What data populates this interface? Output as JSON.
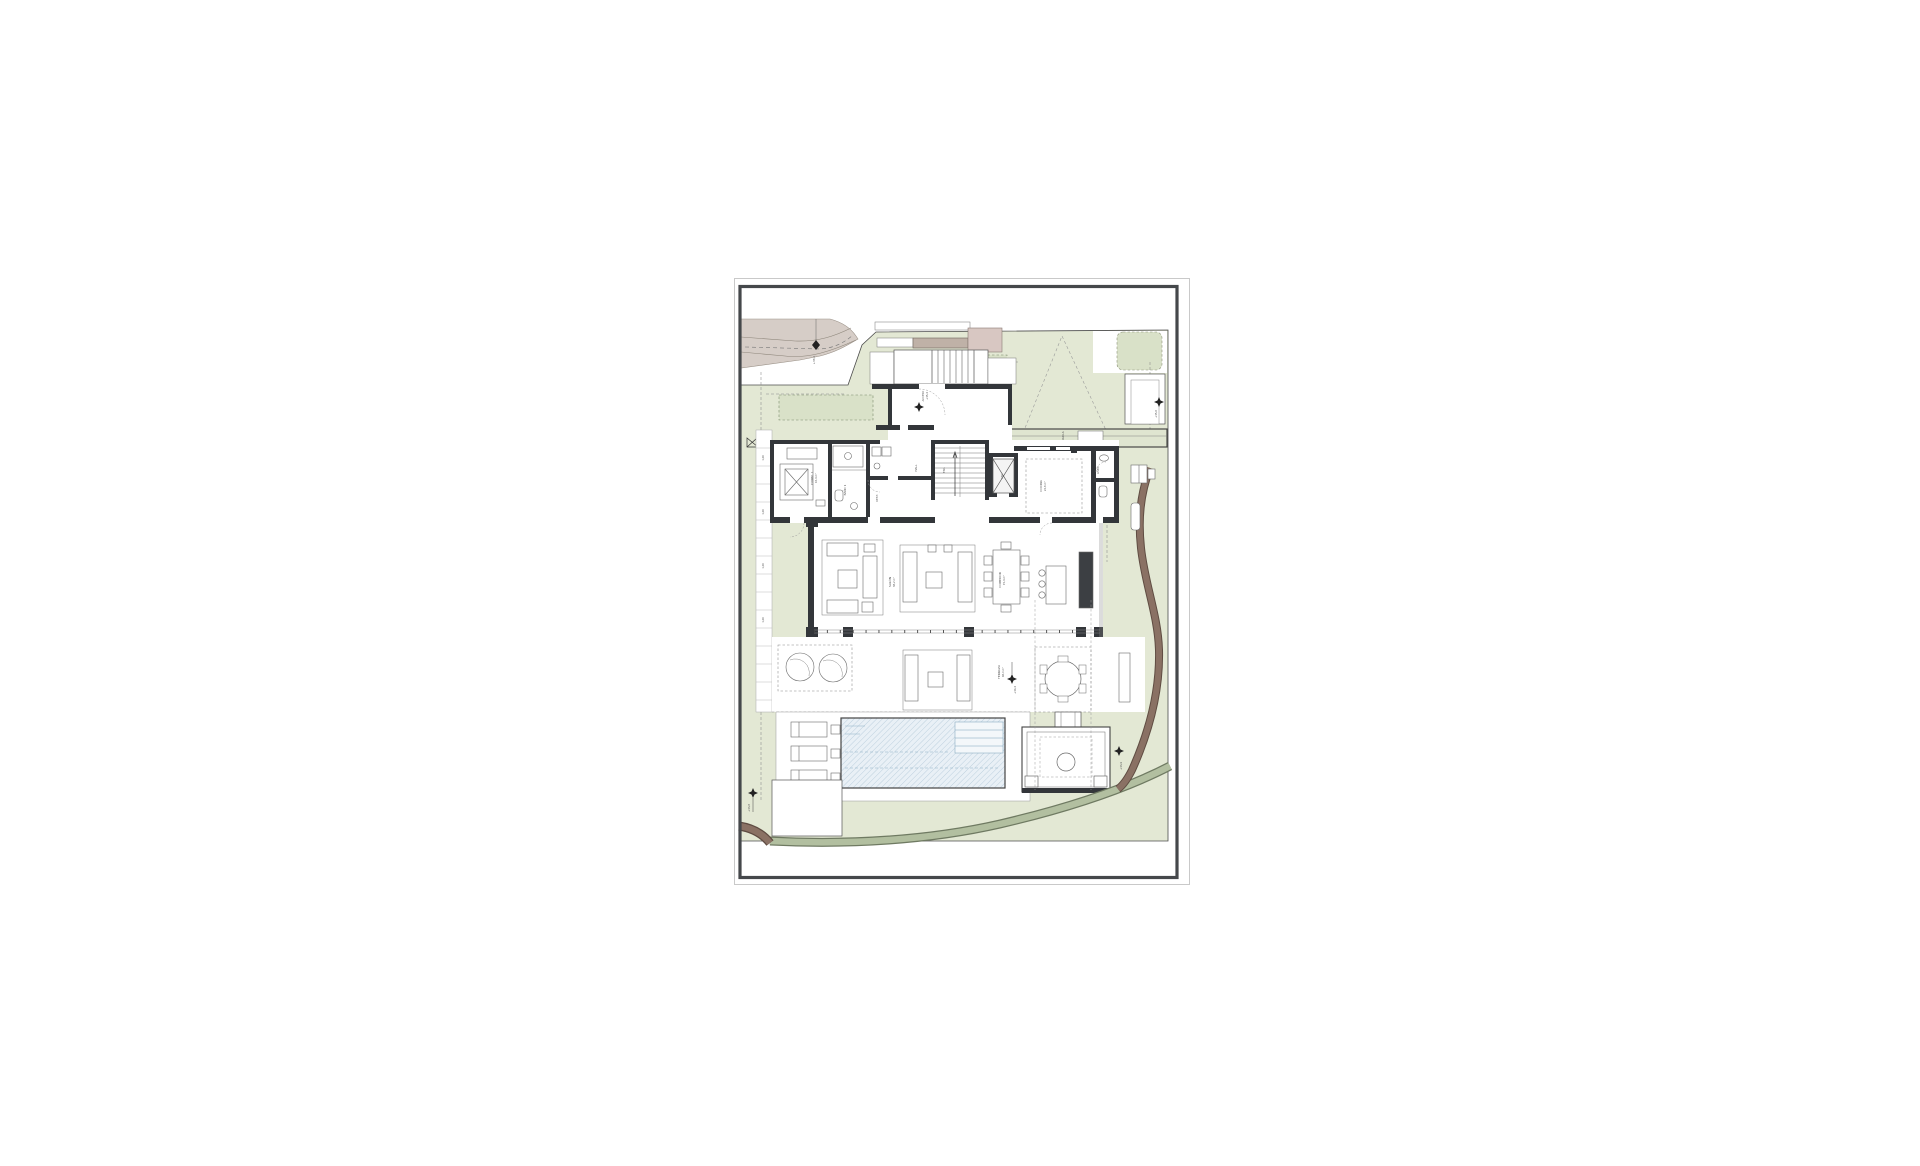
{
  "sheet": {
    "type": "architectural ground floor site plan",
    "colors": {
      "paper": "#ffffff",
      "border_dark": "#45484b",
      "border_light": "#c9c9c9",
      "site_green": "#e3e8d4",
      "bed_green": "#d9e1c8",
      "road": "#d6cdc7",
      "canopy": "#bfb1a7",
      "pink_block": "#d8c7c2",
      "wall": "#33363a",
      "pool_fill": "#e9f0f6",
      "pool_hatch": "#bdd0de",
      "pergola_band": "#dfe5d0",
      "path_brown": "#8a7164",
      "path_sage": "#b2bfa0"
    },
    "labels": {
      "road_elev": "+36,2",
      "entry_access": "ACCESO",
      "entry_elev": "+35,4",
      "gate_elev": "+35,6",
      "pergola": "PÉRGOLA",
      "dorm1": "DORM. 1",
      "dorm1_area": "16,4 m²",
      "bath1": "BAÑO 1",
      "vest": "VEST.",
      "hall": "HALL",
      "stair": "ESC.",
      "lift": "ASC.",
      "kitchen": "COCINA",
      "kitchen_area": "22,6 m²",
      "powder": "ASEO",
      "living": "SALÓN",
      "living_area": "38,2 m²",
      "dining": "COMEDOR",
      "dining_area": "15,4 m²",
      "terrace": "TERRAZA",
      "terrace_area": "46,0 m²",
      "terrace_elev": "+34,4",
      "fire_elev": "+33,9",
      "deck_elev": "+33,8",
      "walk_mark": "1,20"
    }
  }
}
